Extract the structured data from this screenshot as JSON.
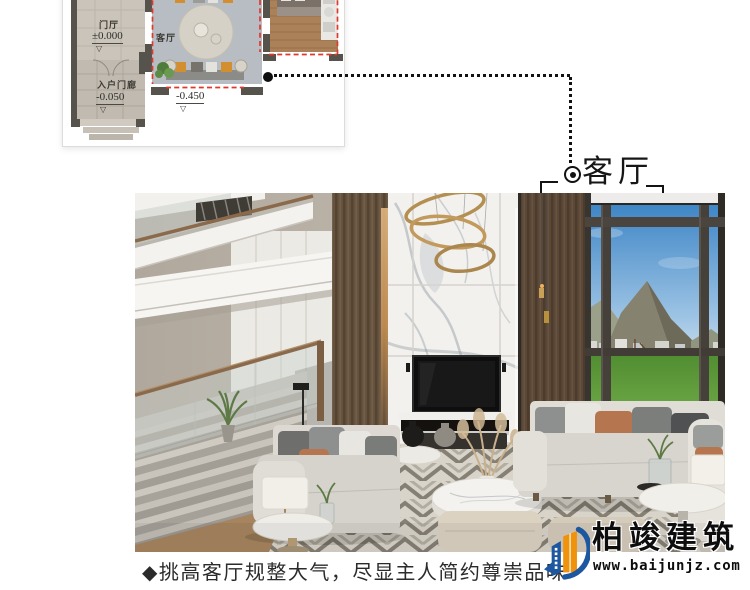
{
  "floor_plan": {
    "entry_hall_label": "门厅",
    "entry_hall_elevation": "±0.000",
    "living_room_label": "客厅",
    "porch_label": "入户门廊",
    "porch_elevation": "-0.050",
    "living_room_elevation": "-0.450",
    "elevation_mark": "▽",
    "highlight_color": "#e0392c"
  },
  "callout": {
    "label": "客厅"
  },
  "caption": {
    "text": "◆挑高客厅规整大气，尽显主人简约尊崇品味"
  },
  "logo": {
    "name": "柏竣建筑",
    "website": "www.baijunjz.com",
    "brand_blue": "#1c57a0",
    "brand_orange": "#f0930c"
  },
  "colors": {
    "callout_text": "#161616",
    "caption_text": "#2b2b2b",
    "connector": "#121212"
  }
}
